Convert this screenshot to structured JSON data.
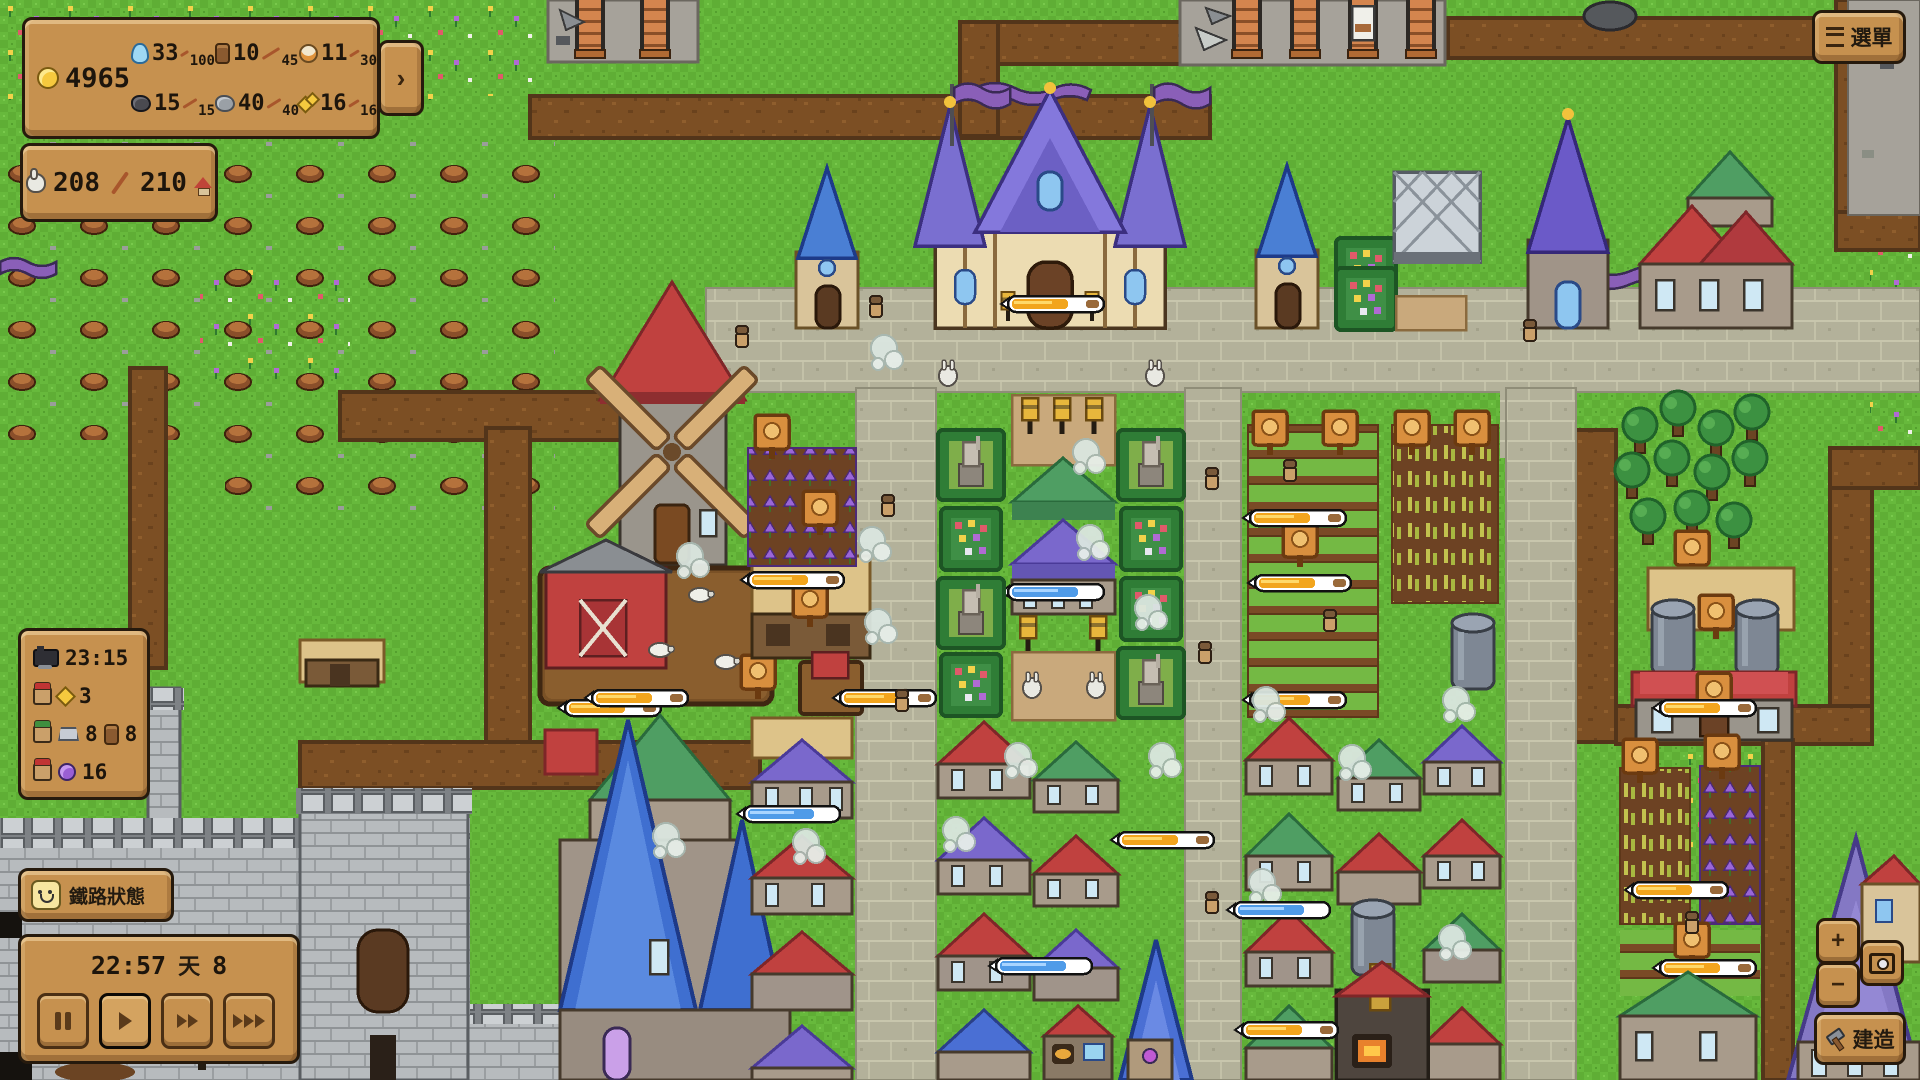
{
  "colors": {
    "panel_wood": "#c6914f",
    "panel_border": "#261a0d",
    "text_dark": "#1d150c",
    "grass": "#63b23a",
    "road": "#b3b19a",
    "dirt": "#7c4f24",
    "bar_fill_orange": "#f2a51d",
    "bar_fill_blue": "#4f9be8",
    "accent_gold": "#f6c93e"
  },
  "hud": {
    "resources": {
      "gold": "4965",
      "items": [
        {
          "name": "water",
          "icon": "water-drop-icon",
          "value": "33",
          "max": "100"
        },
        {
          "name": "wood",
          "icon": "wood-log-icon",
          "value": "10",
          "max": "45"
        },
        {
          "name": "food",
          "icon": "food-jar-icon",
          "value": "11",
          "max": "30"
        },
        {
          "name": "coal",
          "icon": "coal-icon",
          "value": "15",
          "max": "15"
        },
        {
          "name": "stone",
          "icon": "stone-icon",
          "value": "40",
          "max": "40"
        },
        {
          "name": "gold-ore",
          "icon": "gold-ore-icon",
          "value": "16",
          "max": "16"
        }
      ],
      "expand_label": "›"
    },
    "population": {
      "current": "208",
      "separator": "/",
      "max": "210"
    },
    "status_panel": {
      "rows": [
        {
          "icon": "train-icon",
          "value": "23:15"
        },
        {
          "icon": "villager-red-icon",
          "item_icon": "gem-icon",
          "value": "3"
        },
        {
          "icon": "villager-green-icon",
          "item_icon": "iron-ingot-icon",
          "value": "8",
          "item2_icon": "wood-log-icon",
          "value2": "8"
        },
        {
          "icon": "villager-red-icon",
          "item_icon": "amulet-icon",
          "value": "16"
        }
      ]
    },
    "railway_status_button": {
      "icon": "smiley-face-icon",
      "label": "鐵路狀態"
    },
    "time_panel": {
      "clock": "22:57",
      "day_label": "天",
      "day_number": "8",
      "controls": [
        {
          "name": "pause-button",
          "glyph": "pause",
          "active": false
        },
        {
          "name": "play-button",
          "glyph": "play",
          "active": true
        },
        {
          "name": "fast-forward-button",
          "glyph": "fast-forward",
          "active": false
        },
        {
          "name": "fastest-forward-button",
          "glyph": "fastest-forward",
          "active": false
        }
      ]
    },
    "menu_button": {
      "icon": "menu-lines-icon",
      "label": "選單"
    },
    "build_button": {
      "icon": "hammer-icon",
      "label": "建造"
    },
    "map_controls": {
      "zoom_in_label": "+",
      "zoom_out_label": "−",
      "camera_icon": "camera-icon"
    }
  }
}
